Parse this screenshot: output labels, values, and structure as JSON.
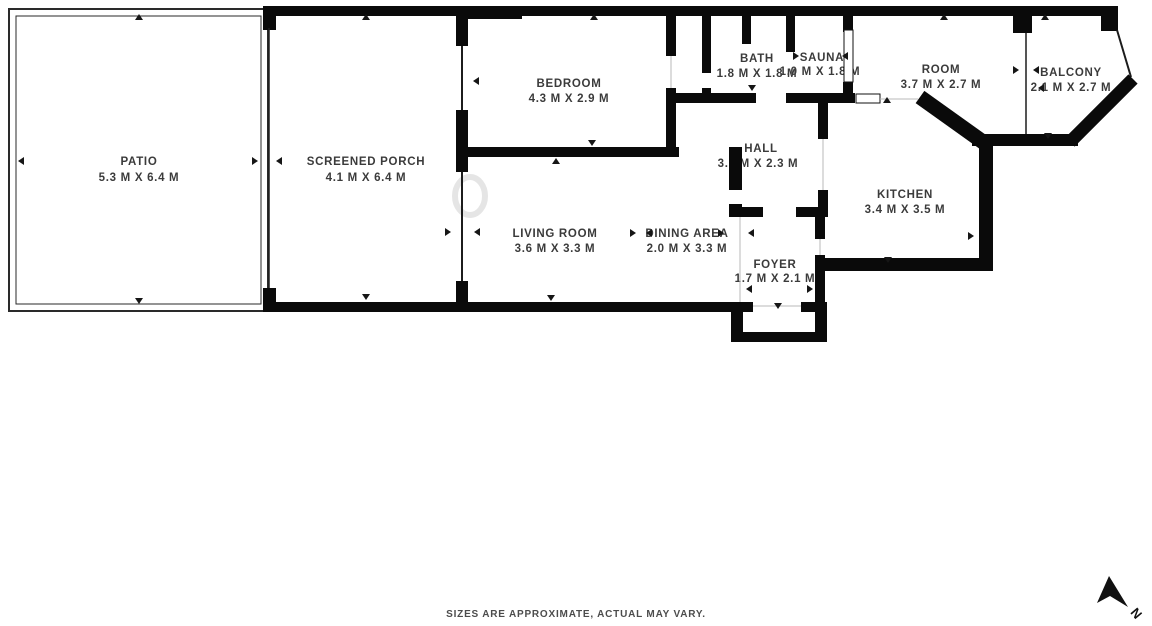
{
  "page": {
    "background": "#ffffff"
  },
  "colors": {
    "wall": "#0a0a0a",
    "label_text": "#3b3b3b",
    "footer_text": "#4c4c4c"
  },
  "rooms": [
    {
      "name": "PATIO",
      "dims": "5.3 M X 6.4 M"
    },
    {
      "name": "SCREENED PORCH",
      "dims": "4.1 M X 6.4 M"
    },
    {
      "name": "BEDROOM",
      "dims": "4.3 M X 2.9 M"
    },
    {
      "name": "BATH",
      "dims": "1.8 M X 1.8 M"
    },
    {
      "name": "SAUNA",
      "dims": "1.0 M X 1.8 M"
    },
    {
      "name": "ROOM",
      "dims": "3.7 M X 2.7 M"
    },
    {
      "name": "BALCONY",
      "dims": "2.1 M X 2.7 M"
    },
    {
      "name": "HALL",
      "dims": "3.1 M X 2.3 M"
    },
    {
      "name": "KITCHEN",
      "dims": "3.4 M X 3.5 M"
    },
    {
      "name": "LIVING ROOM",
      "dims": "3.6 M X 3.3 M"
    },
    {
      "name": "DINING AREA",
      "dims": "2.0 M X 3.3 M"
    },
    {
      "name": "FOYER",
      "dims": "1.7 M X 2.1 M"
    }
  ],
  "footer": {
    "disclaimer": "SIZES ARE APPROXIMATE, ACTUAL MAY VARY."
  },
  "compass": {
    "label": "N"
  }
}
